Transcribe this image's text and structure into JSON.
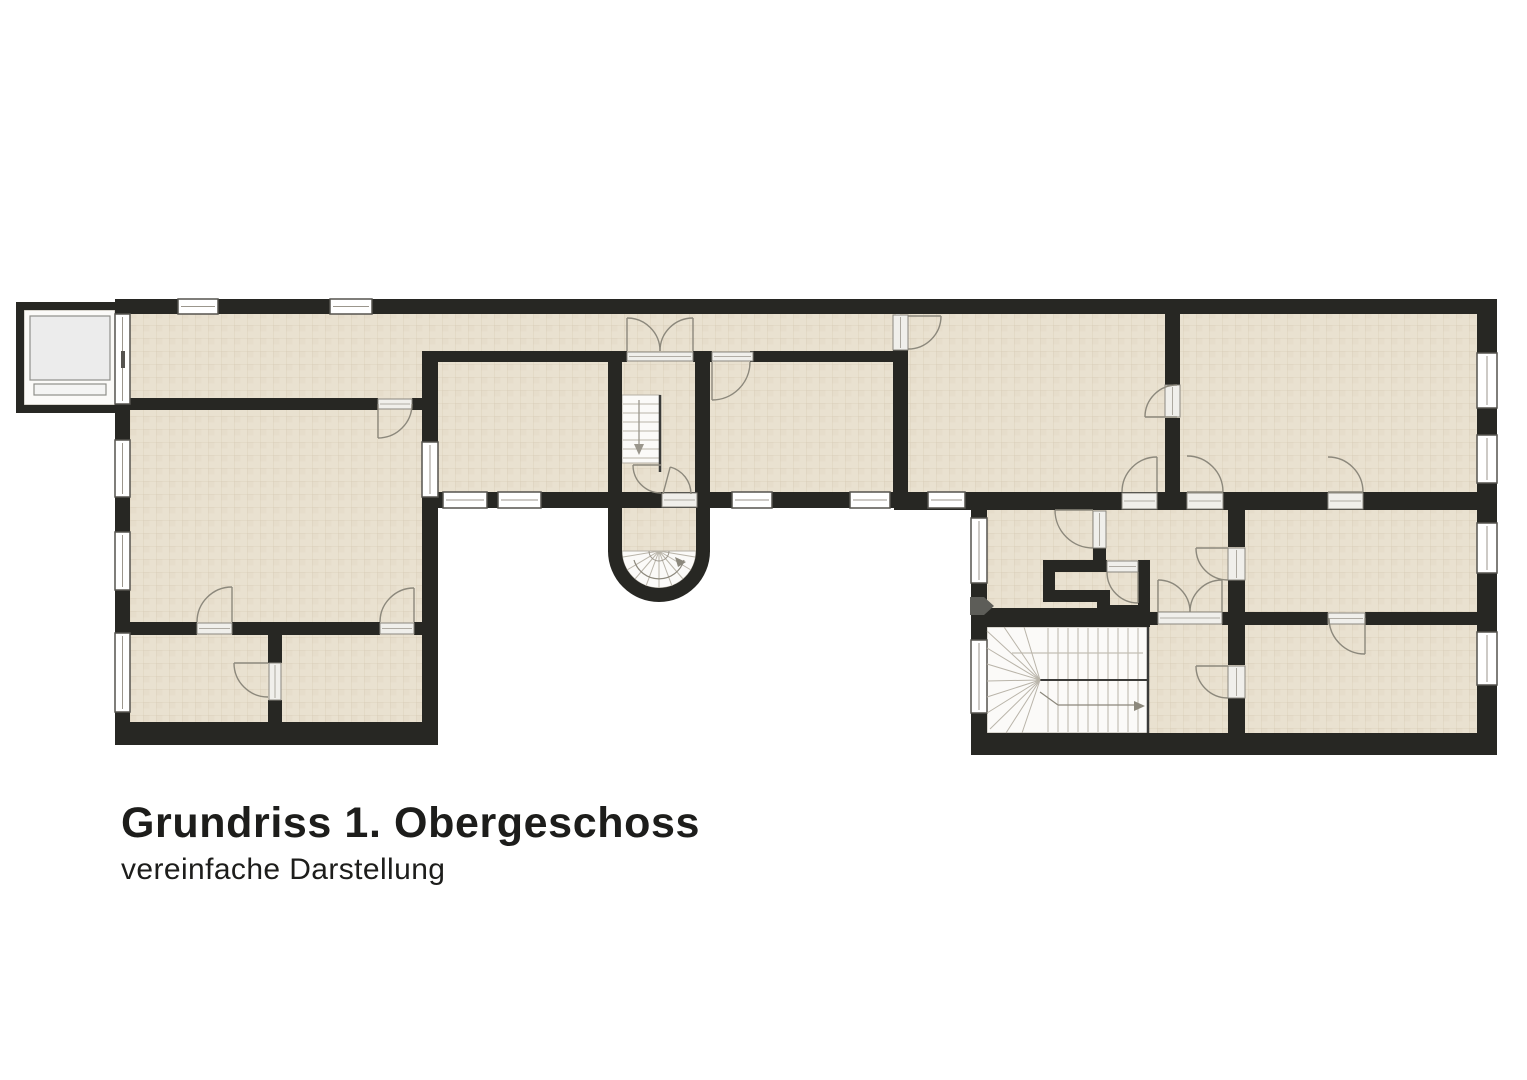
{
  "title": {
    "heading": "Grundriss 1. Obergeschoss",
    "subheading": "vereinfache Darstellung"
  },
  "colors": {
    "wall": "#272723",
    "floor": "#e9e1d0",
    "floor_alt": "#e4dbc7",
    "floor_line": "#cfc1a8",
    "stair": "#fbfaf8",
    "stair_edge": "#b5b0a5",
    "stair_line": "#b9b4a9",
    "stringer": "#3a3a38",
    "rail": "#c4bfb4",
    "arrow": "#9a968c",
    "door": "#8c887c",
    "window_frame": "#55534e",
    "window_line": "#9b968c",
    "sill": "#f0efeb",
    "sill_edge": "#8a877f",
    "marker": "#5d5d58",
    "elev": "#8f8f8b",
    "text": "#1d1d1b"
  },
  "plan": {
    "floor_rects": [
      [
        128,
        312,
        768,
        90
      ],
      [
        128,
        400,
        300,
        335
      ],
      [
        430,
        358,
        190,
        140
      ],
      [
        700,
        358,
        200,
        140
      ],
      [
        615,
        358,
        92,
        150
      ],
      [
        900,
        312,
        280,
        186
      ],
      [
        1172,
        312,
        310,
        186
      ],
      [
        980,
        505,
        502,
        235
      ],
      [
        620,
        498,
        78,
        54
      ]
    ],
    "stair_areas": [
      [
        622,
        395,
        38,
        68
      ],
      [
        987,
        627,
        161,
        106
      ],
      [
        24,
        310,
        91,
        95
      ]
    ],
    "white_paths": [
      "M622,551 A37,37 0 0 0 696,551 Z"
    ],
    "wall_rects": [
      [
        117,
        299,
        1380,
        15
      ],
      [
        115,
        299,
        15,
        446
      ],
      [
        115,
        722,
        322,
        23
      ],
      [
        422,
        353,
        16,
        392
      ],
      [
        422,
        492,
        560,
        16
      ],
      [
        894,
        492,
        603,
        18
      ],
      [
        971,
        505,
        16,
        250
      ],
      [
        971,
        733,
        526,
        22
      ],
      [
        1477,
        299,
        20,
        456
      ],
      [
        117,
        398,
        261,
        12
      ],
      [
        412,
        398,
        26,
        12
      ],
      [
        117,
        622,
        80,
        13
      ],
      [
        232,
        622,
        148,
        13
      ],
      [
        414,
        622,
        24,
        13
      ],
      [
        268,
        635,
        14,
        28
      ],
      [
        268,
        700,
        14,
        23
      ],
      [
        422,
        351,
        205,
        11
      ],
      [
        693,
        351,
        19,
        11
      ],
      [
        750,
        351,
        158,
        11
      ],
      [
        608,
        351,
        14,
        141
      ],
      [
        695,
        362,
        15,
        130
      ],
      [
        608,
        492,
        14,
        60
      ],
      [
        696,
        492,
        14,
        60
      ],
      [
        893,
        299,
        15,
        15
      ],
      [
        893,
        350,
        15,
        142
      ],
      [
        1165,
        314,
        15,
        71
      ],
      [
        1165,
        418,
        15,
        77
      ],
      [
        1093,
        548,
        13,
        16
      ],
      [
        1228,
        505,
        17,
        42
      ],
      [
        1228,
        580,
        17,
        85
      ],
      [
        1228,
        698,
        17,
        37
      ],
      [
        1150,
        612,
        8,
        13
      ],
      [
        1222,
        612,
        106,
        13
      ],
      [
        1365,
        612,
        113,
        13
      ],
      [
        1043,
        560,
        64,
        12
      ],
      [
        1043,
        560,
        12,
        42
      ],
      [
        1043,
        590,
        57,
        12
      ],
      [
        1097,
        590,
        13,
        27
      ],
      [
        1097,
        605,
        53,
        12
      ],
      [
        1138,
        560,
        12,
        57
      ],
      [
        971,
        608,
        179,
        19
      ],
      [
        16,
        302,
        101,
        8
      ],
      [
        16,
        302,
        8,
        111
      ],
      [
        16,
        405,
        101,
        8
      ]
    ],
    "wall_paths": [
      "M608,551 A51,51 0 0 0 710,551 L696,551 A37,37 0 0 1 622,551 Z"
    ],
    "windows": [
      [
        178,
        299,
        40,
        15
      ],
      [
        330,
        299,
        42,
        15
      ],
      [
        115,
        440,
        15,
        57
      ],
      [
        115,
        532,
        15,
        58
      ],
      [
        115,
        633,
        15,
        79
      ],
      [
        422,
        442,
        16,
        55
      ],
      [
        443,
        492,
        44,
        16
      ],
      [
        498,
        492,
        43,
        16
      ],
      [
        732,
        492,
        40,
        16
      ],
      [
        850,
        492,
        40,
        16
      ],
      [
        928,
        492,
        37,
        16
      ],
      [
        971,
        518,
        16,
        65
      ],
      [
        971,
        640,
        16,
        73
      ],
      [
        1477,
        353,
        20,
        55
      ],
      [
        1477,
        435,
        20,
        48
      ],
      [
        1477,
        523,
        20,
        50
      ],
      [
        1477,
        632,
        20,
        53
      ],
      [
        115,
        314,
        15,
        90
      ]
    ],
    "sills": [
      [
        627,
        352,
        66,
        9
      ],
      [
        712,
        352,
        41,
        9
      ],
      [
        662,
        493,
        35,
        14
      ],
      [
        1122,
        493,
        35,
        16
      ],
      [
        1187,
        493,
        36,
        16
      ],
      [
        1328,
        493,
        35,
        16
      ],
      [
        1158,
        612,
        64,
        12
      ],
      [
        1328,
        613,
        37,
        11
      ],
      [
        378,
        399,
        34,
        10
      ],
      [
        893,
        315,
        15,
        35
      ],
      [
        1165,
        385,
        15,
        32
      ],
      [
        1228,
        548,
        17,
        32
      ],
      [
        1228,
        666,
        17,
        32
      ],
      [
        1093,
        511,
        13,
        37
      ],
      [
        1107,
        561,
        31,
        11
      ],
      [
        197,
        623,
        35,
        11
      ],
      [
        380,
        623,
        34,
        11
      ],
      [
        269,
        663,
        12,
        37
      ]
    ],
    "doors": [
      [
        378,
        404,
        34,
        0,
        90
      ],
      [
        627,
        351,
        33,
        0,
        -90
      ],
      [
        693,
        351,
        33,
        180,
        270
      ],
      [
        712,
        362,
        38,
        0,
        90
      ],
      [
        661,
        465,
        28,
        90,
        180
      ],
      [
        663,
        494,
        28,
        0,
        -75
      ],
      [
        908,
        316,
        33,
        90,
        0
      ],
      [
        1177,
        417,
        32,
        270,
        180
      ],
      [
        1157,
        492,
        35,
        180,
        270
      ],
      [
        1187,
        492,
        36,
        270,
        360
      ],
      [
        1328,
        492,
        35,
        270,
        360
      ],
      [
        1093,
        510,
        38,
        90,
        180
      ],
      [
        1138,
        572,
        31,
        180,
        90
      ],
      [
        1228,
        548,
        32,
        90,
        180
      ],
      [
        1228,
        666,
        32,
        90,
        180
      ],
      [
        1158,
        612,
        32,
        0,
        -90
      ],
      [
        1222,
        612,
        32,
        180,
        270
      ],
      [
        1365,
        618,
        36,
        180,
        90
      ],
      [
        232,
        622,
        35,
        180,
        270
      ],
      [
        414,
        622,
        34,
        180,
        270
      ],
      [
        268,
        663,
        34,
        90,
        180
      ]
    ],
    "lines": [
      [
        623,
        404,
        659,
        404,
        1,
        "stair_line"
      ],
      [
        623,
        413,
        659,
        413,
        1,
        "stair_line"
      ],
      [
        623,
        422,
        659,
        422,
        1,
        "stair_line"
      ],
      [
        623,
        431,
        659,
        431,
        1,
        "stair_line"
      ],
      [
        623,
        440,
        659,
        440,
        1,
        "stair_line"
      ],
      [
        623,
        449,
        659,
        449,
        1,
        "stair_line"
      ],
      [
        623,
        458,
        659,
        458,
        1,
        "stair_line"
      ],
      [
        660,
        395,
        660,
        472,
        2.5,
        "stringer"
      ],
      [
        639,
        400,
        639,
        447,
        1.3,
        "arrow"
      ],
      [
        1048,
        628,
        1048,
        732,
        1,
        "stair_line"
      ],
      [
        1058,
        628,
        1058,
        732,
        1,
        "stair_line"
      ],
      [
        1068,
        628,
        1068,
        732,
        1,
        "stair_line"
      ],
      [
        1078,
        628,
        1078,
        732,
        1,
        "stair_line"
      ],
      [
        1088,
        628,
        1088,
        732,
        1,
        "stair_line"
      ],
      [
        1098,
        628,
        1098,
        732,
        1,
        "stair_line"
      ],
      [
        1108,
        628,
        1108,
        732,
        1,
        "stair_line"
      ],
      [
        1118,
        628,
        1118,
        732,
        1,
        "stair_line"
      ],
      [
        1128,
        628,
        1128,
        732,
        1,
        "stair_line"
      ],
      [
        1138,
        628,
        1138,
        732,
        1,
        "stair_line"
      ],
      [
        1040,
        680,
        1147,
        680,
        2,
        "stringer"
      ],
      [
        1012,
        653,
        1143,
        653,
        1.2,
        "rail"
      ],
      [
        1040,
        680,
        1024,
        627,
        1,
        "stair_line"
      ],
      [
        1040,
        680,
        1004,
        627,
        1,
        "stair_line"
      ],
      [
        1040,
        680,
        987,
        631,
        1,
        "stair_line"
      ],
      [
        1040,
        680,
        987,
        648,
        1,
        "stair_line"
      ],
      [
        1040,
        680,
        987,
        664,
        1,
        "stair_line"
      ],
      [
        1040,
        680,
        987,
        681,
        1,
        "stair_line"
      ],
      [
        1040,
        680,
        987,
        697,
        1,
        "stair_line"
      ],
      [
        1040,
        680,
        987,
        713,
        1,
        "stair_line"
      ],
      [
        1040,
        680,
        990,
        729,
        1,
        "stair_line"
      ],
      [
        1040,
        680,
        1006,
        733,
        1,
        "stair_line"
      ],
      [
        1040,
        680,
        1022,
        733,
        1,
        "stair_line"
      ],
      [
        1040,
        692,
        1058,
        705,
        1.2,
        "door"
      ],
      [
        1058,
        705,
        1136,
        705,
        1.2,
        "door"
      ],
      [
        659,
        551,
        695,
        557,
        1,
        "stair_line"
      ],
      [
        659,
        551,
        691,
        570,
        1,
        "stair_line"
      ],
      [
        659,
        551,
        683,
        579,
        1,
        "stair_line"
      ],
      [
        659,
        551,
        672,
        586,
        1,
        "stair_line"
      ],
      [
        659,
        551,
        659,
        588,
        1,
        "stair_line"
      ],
      [
        659,
        551,
        646,
        586,
        1,
        "stair_line"
      ],
      [
        659,
        551,
        635,
        579,
        1,
        "stair_line"
      ],
      [
        659,
        551,
        627,
        570,
        1,
        "stair_line"
      ],
      [
        659,
        551,
        623,
        557,
        1,
        "stair_line"
      ],
      [
        1148,
        627,
        1148,
        733,
        2.5,
        "stringer"
      ],
      [
        31,
        317,
        109,
        379,
        1.2,
        "elev"
      ],
      [
        109,
        317,
        31,
        379,
        1.2,
        "elev"
      ]
    ],
    "stroke_paths": [
      [
        "M634,560 A26,26 0 0 0 684,560",
        1.2,
        "door"
      ],
      [
        "M649,551 A10,10 0 0 0 669,551",
        1,
        "window_line"
      ]
    ],
    "polys": [
      [
        [
          970,
          597,
          984,
          597,
          994,
          606,
          984,
          615,
          970,
          615
        ],
        "marker"
      ],
      [
        [
          639,
          455,
          634,
          444,
          644,
          444
        ],
        "arrow"
      ],
      [
        [
          686,
          562,
          675,
          557,
          678,
          567
        ],
        "door"
      ],
      [
        [
          1145,
          706,
          1134,
          701,
          1134,
          711
        ],
        "door"
      ]
    ],
    "gray_rects": [
      [
        30,
        316,
        80,
        64,
        "#ececec",
        "#8f8f8b"
      ],
      [
        34,
        384,
        72,
        11,
        "#f4f4f3",
        "#8f8f8b"
      ],
      [
        121,
        351,
        4,
        17,
        "#55534f",
        "none"
      ]
    ]
  }
}
